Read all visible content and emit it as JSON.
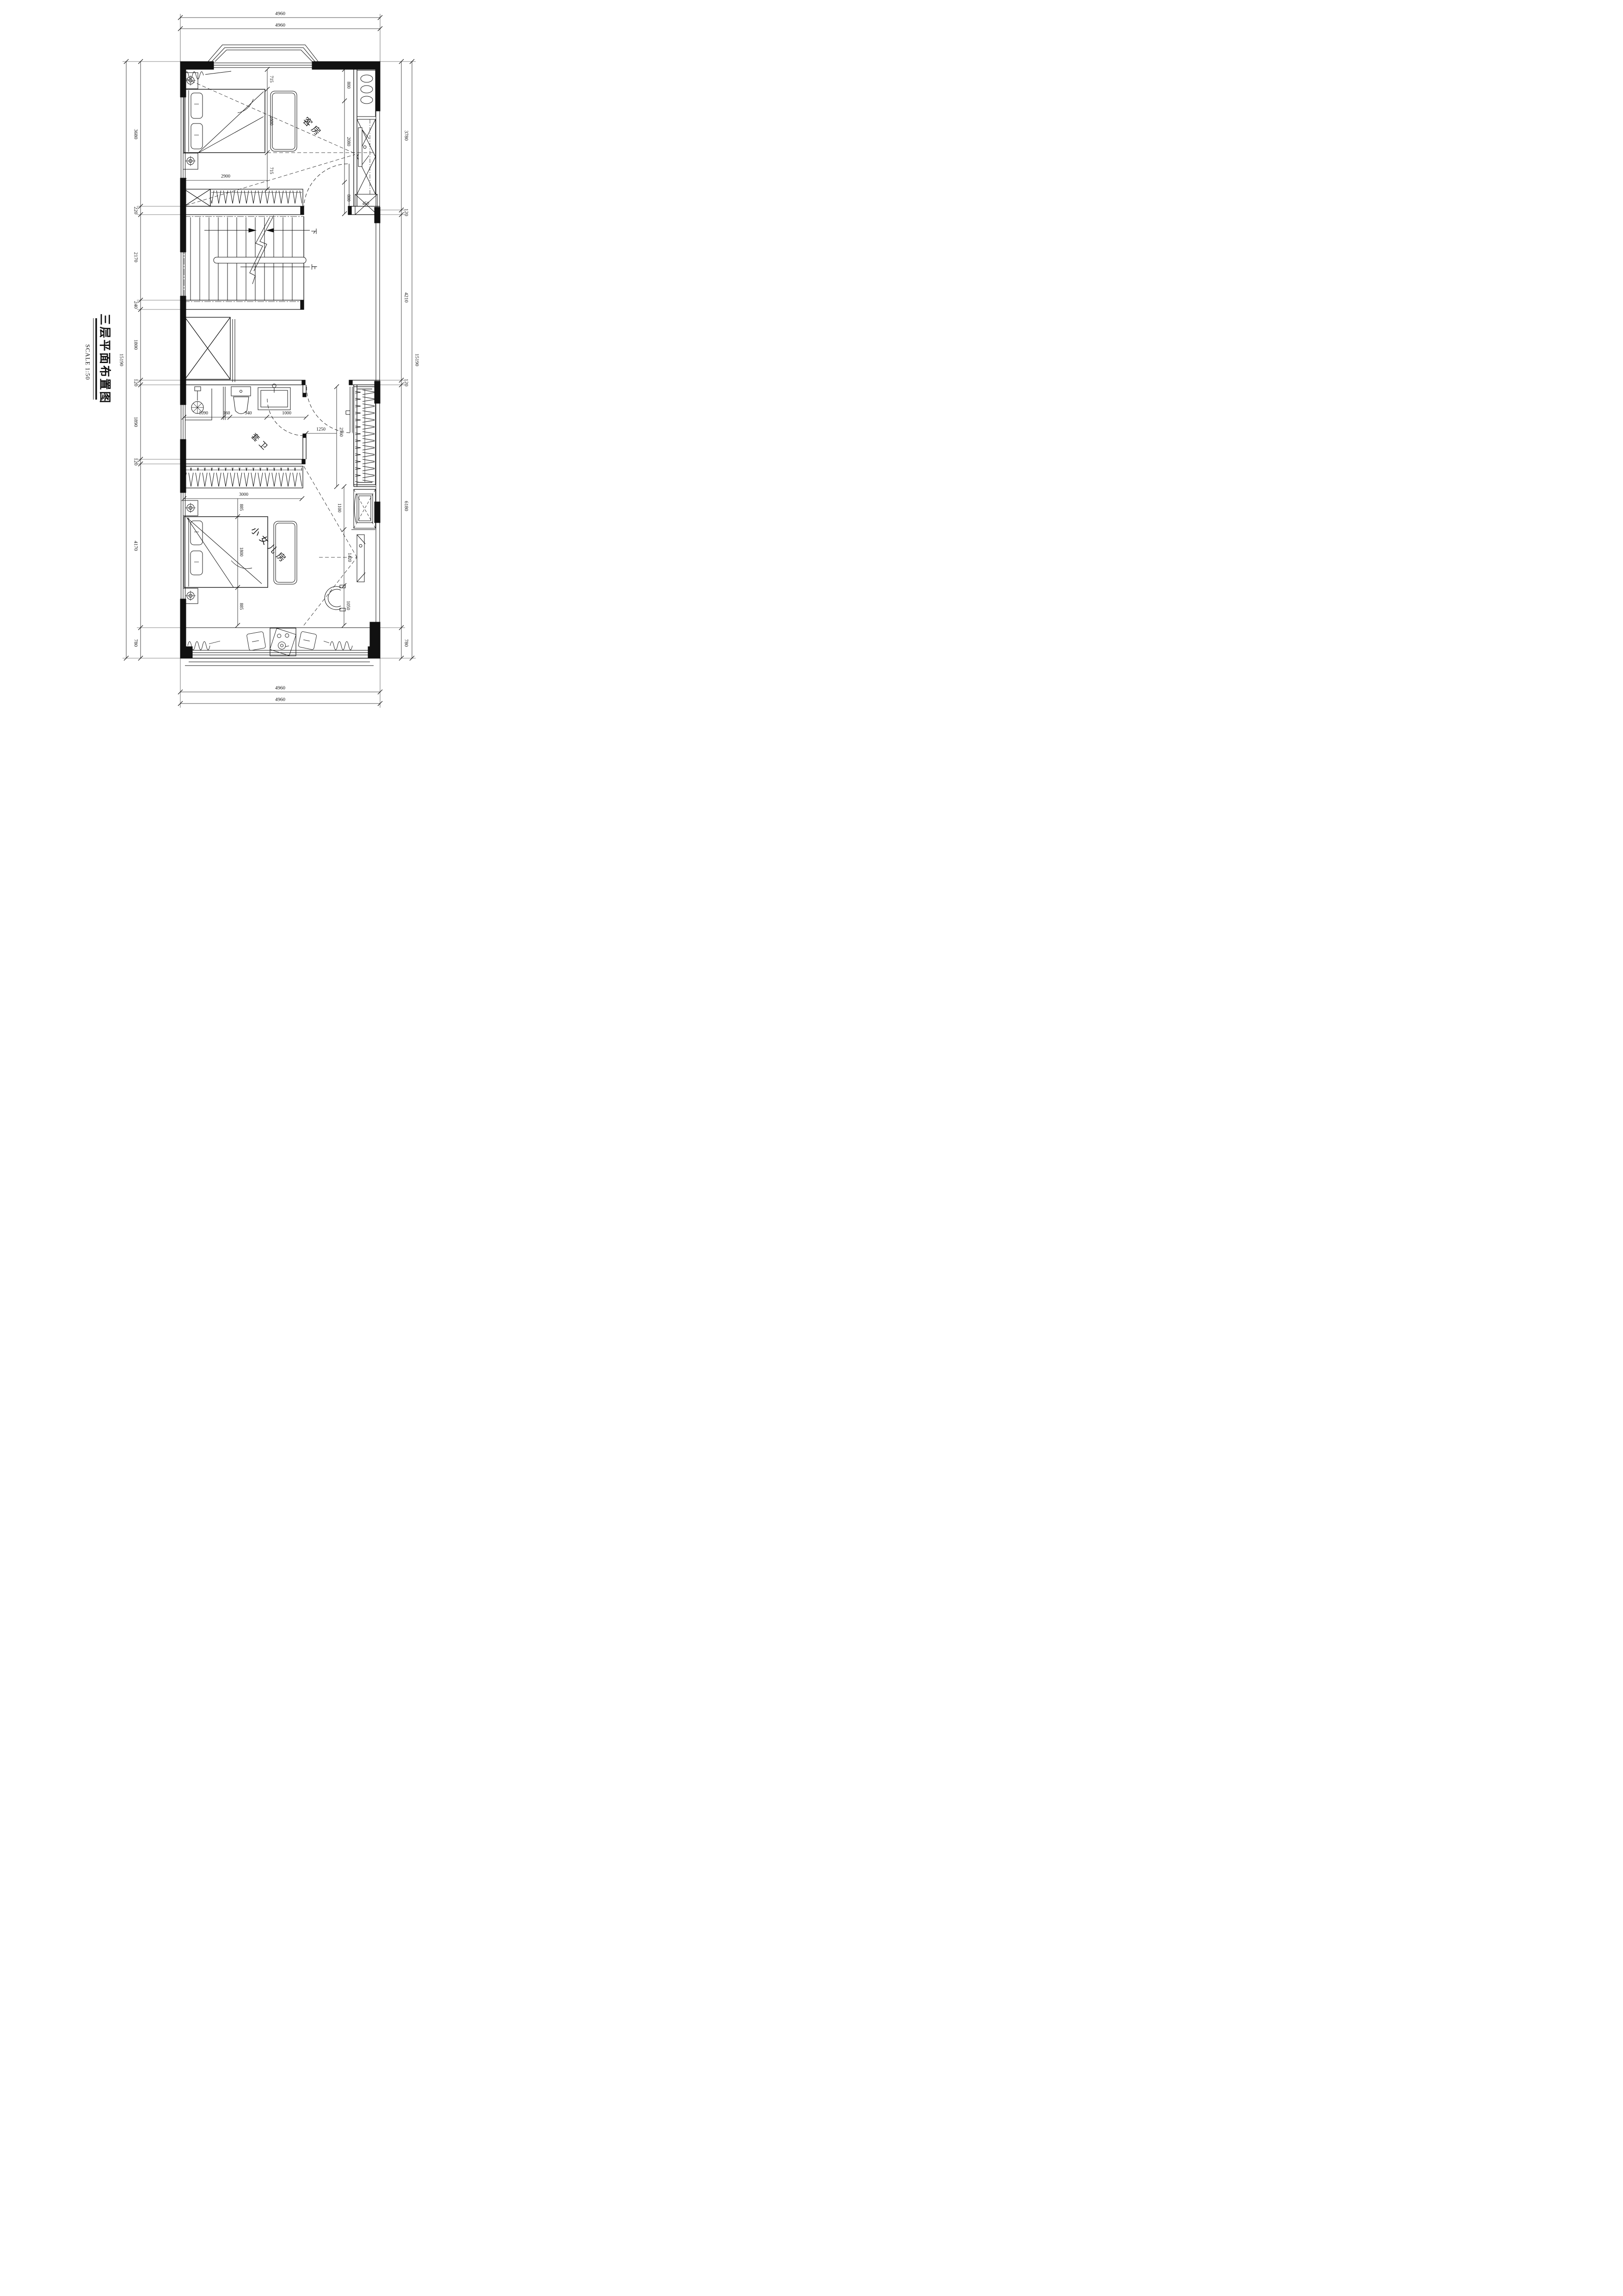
{
  "title": {
    "text": "三层平面布置图",
    "scale": "SCALE 1:50"
  },
  "rooms": {
    "guest": "客房",
    "bath": "套卫",
    "girl": "小女儿房"
  },
  "stairs": {
    "down": "下",
    "up": "上"
  },
  "dims": {
    "top": [
      "4960",
      "4960"
    ],
    "bottom": [
      "4960",
      "4960"
    ],
    "left_total": "15190",
    "right_total": "15190",
    "left_chain": [
      "3680",
      "220",
      "2170",
      "240",
      "1800",
      "120",
      "1890",
      "120",
      "4170",
      "780"
    ],
    "right_chain": [
      "3780",
      "120",
      "4210",
      "120",
      "6180",
      "780"
    ],
    "guest": {
      "bed_chain": [
        "715",
        "1600",
        "715"
      ],
      "wardrobe": "2900",
      "closet_chain": [
        "800",
        "2080",
        "800"
      ],
      "closet_depth": "450"
    },
    "bath": {
      "chain": [
        "1090",
        "160",
        "940",
        "1000"
      ]
    },
    "hall": {
      "door": "1250",
      "wardrobe": "2560"
    },
    "girl": {
      "wardrobe": "3000",
      "chain": [
        "885",
        "1800",
        "885"
      ],
      "cabinet": "1100",
      "window": "1420",
      "chair": "1050"
    }
  }
}
